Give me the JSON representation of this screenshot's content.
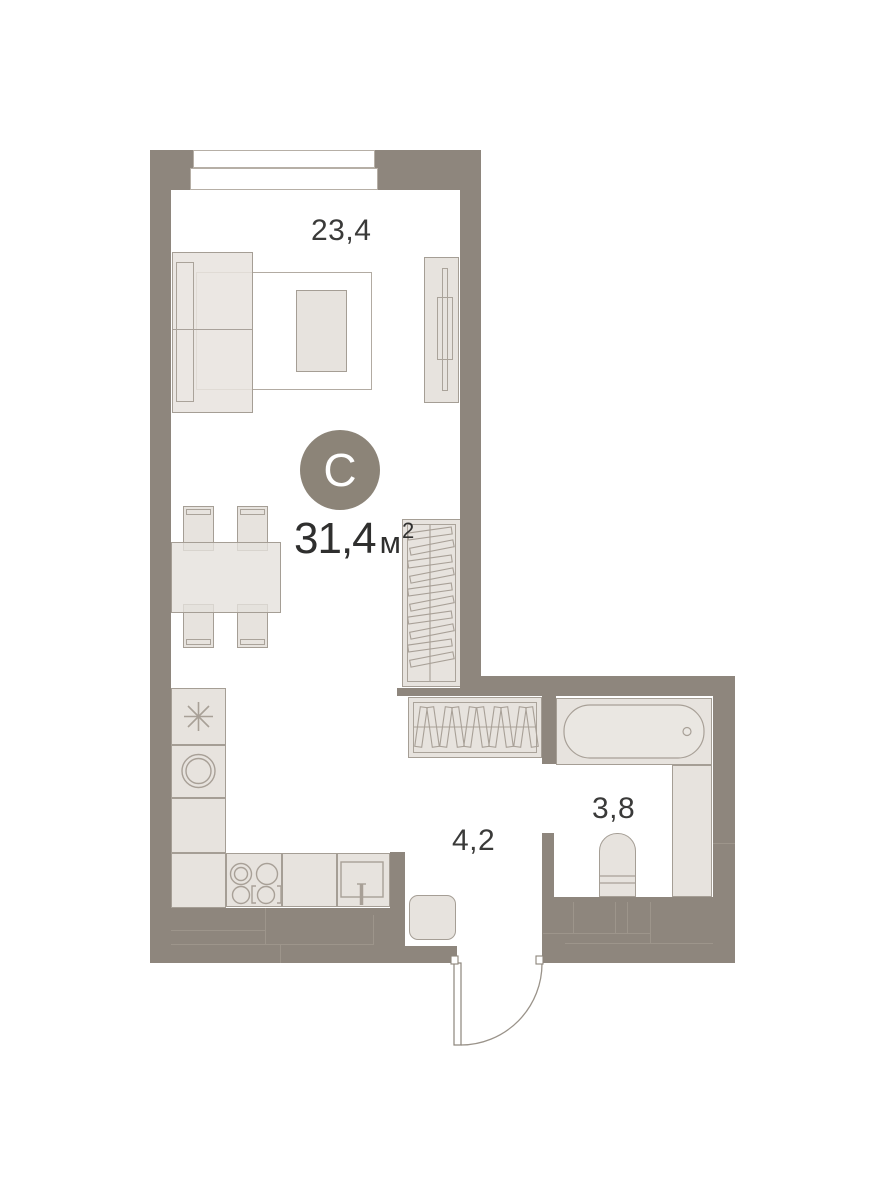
{
  "plan": {
    "unit_type_badge": "С",
    "total_area_value": "31,4",
    "total_area_unit": "м",
    "total_area_exponent": "2",
    "room_areas": {
      "living_room": "23,4",
      "hallway": "4,2",
      "bathroom": "3,8"
    },
    "colors": {
      "wall": "#8e867d",
      "furniture_fill": "#e7e3de",
      "furniture_line": "#a59e95",
      "text": "#3a3a39",
      "badge_background": "#8c8478",
      "badge_text": "#ffffff",
      "background": "#ffffff"
    }
  }
}
